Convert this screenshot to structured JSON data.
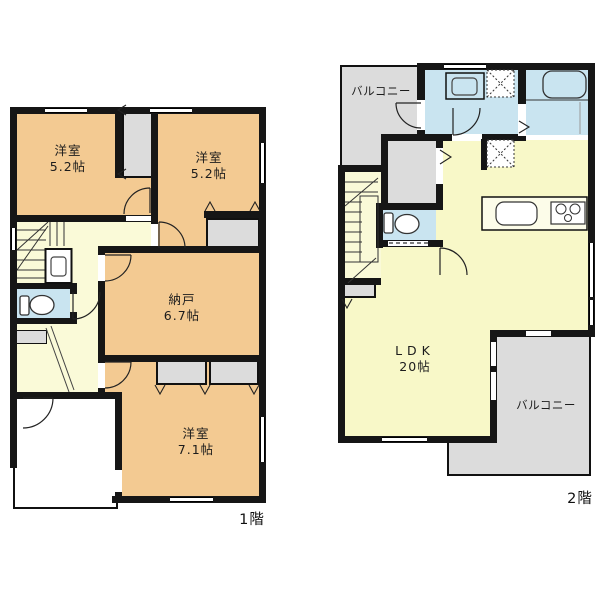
{
  "floor1": {
    "caption": "1階",
    "bedroom_tl": {
      "name": "洋室",
      "size": "5.2帖"
    },
    "bedroom_tr": {
      "name": "洋室",
      "size": "5.2帖"
    },
    "storage": {
      "name": "納戸",
      "size": "6.7帖"
    },
    "bedroom_bottom": {
      "name": "洋室",
      "size": "7.1帖"
    }
  },
  "floor2": {
    "caption": "2階",
    "balcony_top": {
      "name": "バルコニー"
    },
    "living": {
      "name": "LDK",
      "size": "20帖"
    },
    "balcony_bottom": {
      "name": "バルコニー"
    }
  },
  "colors": {
    "room_orange": "#F3CA92",
    "hall_yellow": "#FAFAD8",
    "ldk_yellow": "#F8F8C8",
    "wet_area_blue": "#C9E4F0",
    "balcony_gray": "#DCDCDC",
    "wall_black": "#161616"
  }
}
